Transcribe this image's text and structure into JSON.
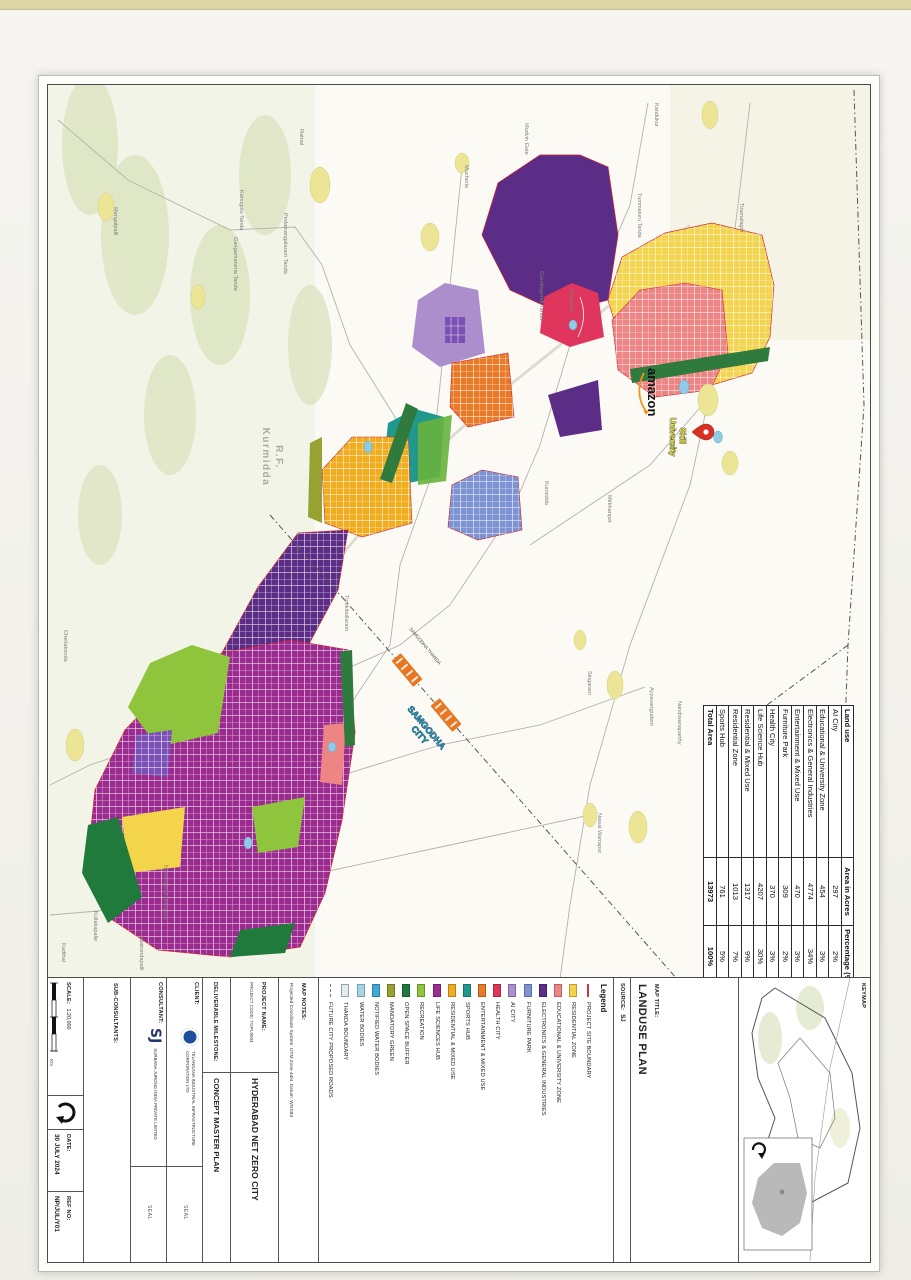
{
  "page": {
    "top_strip": ""
  },
  "map": {
    "forest_label_line1": "R.F.",
    "forest_label_line2": "Kurmidda",
    "amazon_label": "amazon",
    "skill_university_line1": "Skill",
    "skill_university_line2": "University",
    "samgodha_station_label": "SAMGODHA THANDA",
    "samgodha_city_line1": "SAMGODHA",
    "samgodha_city_line2": "CITY",
    "villages": [
      {
        "x": 18,
        "y": 215,
        "label": "Kandukur"
      },
      {
        "x": 108,
        "y": 232,
        "label": "Tummaluru Tanda"
      },
      {
        "x": 118,
        "y": 130,
        "label": "Tirumalagiri"
      },
      {
        "x": 38,
        "y": 345,
        "label": "Mudvin Gate"
      },
      {
        "x": 80,
        "y": 405,
        "label": "Mucherla"
      },
      {
        "x": 44,
        "y": 570,
        "label": "Ratnal"
      },
      {
        "x": 122,
        "y": 756,
        "label": "Mangalpalli"
      },
      {
        "x": 105,
        "y": 630,
        "label": "Kanugolu Tanda"
      },
      {
        "x": 128,
        "y": 586,
        "label": "Pedamangalaram Tanda"
      },
      {
        "x": 152,
        "y": 636,
        "label": "Gangamaneria Tanda"
      },
      {
        "x": 186,
        "y": 330,
        "label": "Gurralagondi Tanda"
      },
      {
        "x": 204,
        "y": 300,
        "label": "Sarlapalli"
      },
      {
        "x": 396,
        "y": 325,
        "label": "Kurmidda"
      },
      {
        "x": 410,
        "y": 262,
        "label": "Mirkhanpet"
      },
      {
        "x": 510,
        "y": 525,
        "label": "Tunikibollaram"
      },
      {
        "x": 586,
        "y": 282,
        "label": "Singaram"
      },
      {
        "x": 602,
        "y": 220,
        "label": "Ayyavartgudem"
      },
      {
        "x": 616,
        "y": 192,
        "label": "Nandiwanaparthy"
      },
      {
        "x": 728,
        "y": 272,
        "label": "Nawal Warrapur"
      },
      {
        "x": 780,
        "y": 706,
        "label": "Nednametla Medipally"
      },
      {
        "x": 826,
        "y": 776,
        "label": "Kullakapalle"
      },
      {
        "x": 850,
        "y": 730,
        "label": "Talakondapalli"
      },
      {
        "x": 858,
        "y": 808,
        "label": "Kadthal"
      },
      {
        "x": 545,
        "y": 806,
        "label": "Cherlakonda"
      }
    ]
  },
  "landuse_table": {
    "headers": [
      "Land use",
      "Area in Acres",
      "Percentage (%)"
    ],
    "rows": [
      [
        "AI City",
        "297",
        "2%"
      ],
      [
        "Educational & University Zone",
        "454",
        "3%"
      ],
      [
        "Electronics & General Industries",
        "4774",
        "34%"
      ],
      [
        "Entertainment & Mixed Use",
        "470",
        "3%"
      ],
      [
        "Furniture Park",
        "309",
        "2%"
      ],
      [
        "Health City",
        "370",
        "3%"
      ],
      [
        "Life Science Hub",
        "4207",
        "30%"
      ],
      [
        "Residential & Mixed Use",
        "1317",
        "9%"
      ],
      [
        "Residential Zone",
        "1013",
        "7%"
      ],
      [
        "Sports Hub",
        "761",
        "5%"
      ]
    ],
    "total_row": [
      "Total Area",
      "13973",
      "100%"
    ]
  },
  "titleblock": {
    "keymap_label": "KEYMAP",
    "map_title_label": "MAP TITLE:",
    "map_title": "LANDUSE PLAN",
    "source_label": "SOURCE:",
    "source_value": "SJ",
    "legend_title": "Legend",
    "legend": [
      {
        "label": "PROJECT SITE BOUNDARY",
        "color": "#cc3344",
        "type": "line"
      },
      {
        "label": "RESIDENTIAL ZONE",
        "color": "#f3d44b",
        "type": "box"
      },
      {
        "label": "EDUCATIONAL & UNIVERSITY ZONE",
        "color": "#ee8585",
        "type": "box"
      },
      {
        "label": "ELECTRONICS & GENERAL INDUSTRIES",
        "color": "#5c2d87",
        "type": "box"
      },
      {
        "label": "FURNITURE PARK",
        "color": "#7e93d2",
        "type": "box"
      },
      {
        "label": "AI CITY",
        "color": "#ab8ecb",
        "type": "box"
      },
      {
        "label": "HEALTH CITY",
        "color": "#e0355c",
        "type": "box"
      },
      {
        "label": "ENTERTAINMENT & MIXED USE",
        "color": "#e97b28",
        "type": "box"
      },
      {
        "label": "SPORTS HUB",
        "color": "#20998c",
        "type": "box"
      },
      {
        "label": "RESIDENTIAL & MIXED USE",
        "color": "#f0ad1f",
        "type": "box"
      },
      {
        "label": "LIFE SCIENCES HUB",
        "color": "#9c2b90",
        "type": "box"
      },
      {
        "label": "RECREATION",
        "color": "#8fc43d",
        "type": "box"
      },
      {
        "label": "OPEN SPACE BUFFER",
        "color": "#207a3c",
        "type": "box"
      },
      {
        "label": "MANDATORY GREEN",
        "color": "#98a233",
        "type": "box"
      },
      {
        "label": "NOTIFIED WATER BODIES",
        "color": "#3fa8d8",
        "type": "box"
      },
      {
        "label": "WATER BODIES",
        "color": "#a5d3e6",
        "type": "box"
      },
      {
        "label": "THANDA BOUNDARY",
        "color": "#e3ebee",
        "type": "outline"
      },
      {
        "label": "FUTURE CITY PROPOSED ROADS",
        "color": "#777777",
        "type": "dash"
      }
    ],
    "map_notes_label": "MAP NOTES:",
    "map_notes": "Projected Coordinate System: UTM Zone 44N, Datum: WGS84",
    "project_name_label": "PROJECT NAME:",
    "project_code": "PROJECT CODE: TGPL9004",
    "project_name": "HYDERABAD NET ZERO CITY",
    "deliverable_label": "DELIVERABLE MILESTONE:",
    "deliverable": "CONCEPT MASTER PLAN",
    "client_label": "CLIENT:",
    "client_name": "Telangana Industrial Infrastructure Corporation Ltd",
    "consultant_label": "CONSULTANT:",
    "consultant_logo": "SJ",
    "consultant_name": "Surbana Jurong India Private Limited",
    "subconsultants_label": "SUB-CONSULTANTS:",
    "seal_label": "SEAL",
    "scale_label": "SCALE:",
    "scale_value": "1:20,000",
    "scale_km": "Km",
    "date_label": "DATE:",
    "date_value": "30 JULY 2024",
    "ref_label": "REF NO:",
    "ref_value": "NP/JUL/Y01"
  }
}
